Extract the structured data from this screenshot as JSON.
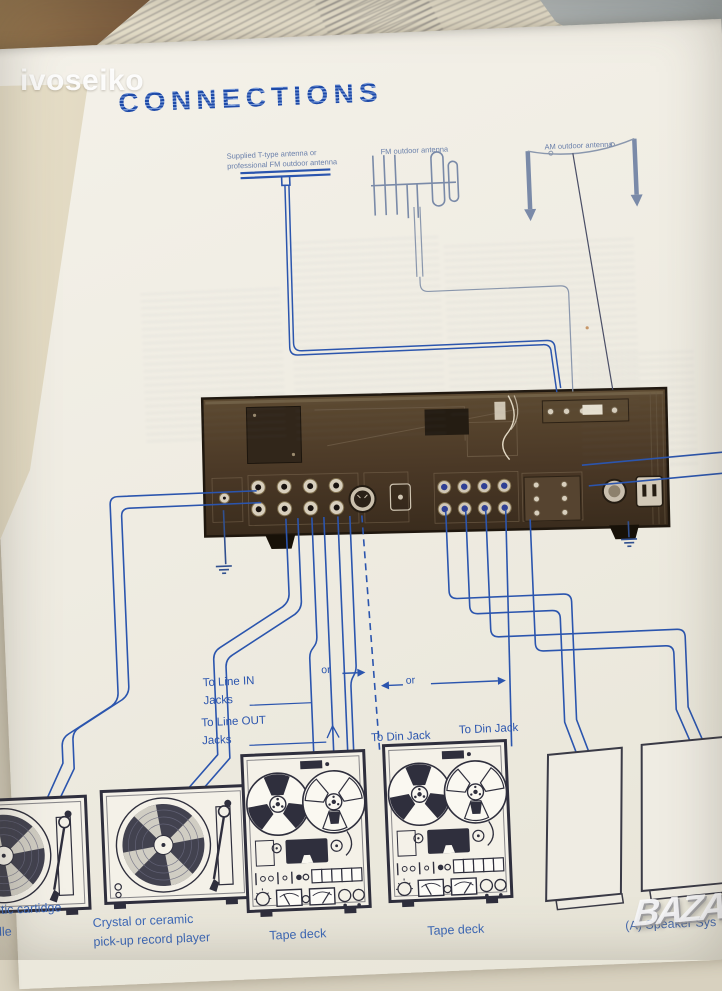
{
  "photo": {
    "watermark_top_left": "ivoseiko",
    "watermark_bottom_right": "BAZAR"
  },
  "page": {
    "title": "CONNECTIONS",
    "antennas": {
      "t_type_label": "Supplied T-type antenna or\nprofessional FM outdoor antenna",
      "fm_label": "FM outdoor antenna",
      "am_label": "AM outdoor antenna"
    },
    "wiring": {
      "line_in_label": "To Line IN\nJacks",
      "line_out_label": "To Line OUT\nJacks",
      "or_1": "or",
      "or_2": "or",
      "din_1": "To Din Jack",
      "din_2": "To Din Jack"
    },
    "captions": {
      "turntable_1": "etic cartidge\ndle",
      "turntable_2": "Crystal or ceramic\npick-up record player",
      "tape_deck_1": "Tape deck",
      "tape_deck_2": "Tape deck",
      "speakers": "(A) Speaker Sys"
    }
  },
  "colors": {
    "diagram_blue": "#2b55ae",
    "label_blue": "#3c68b8",
    "panel_brown": "#4e3c28",
    "line_art_ink": "#2f2f3d",
    "page_background": "#f2efe6"
  }
}
